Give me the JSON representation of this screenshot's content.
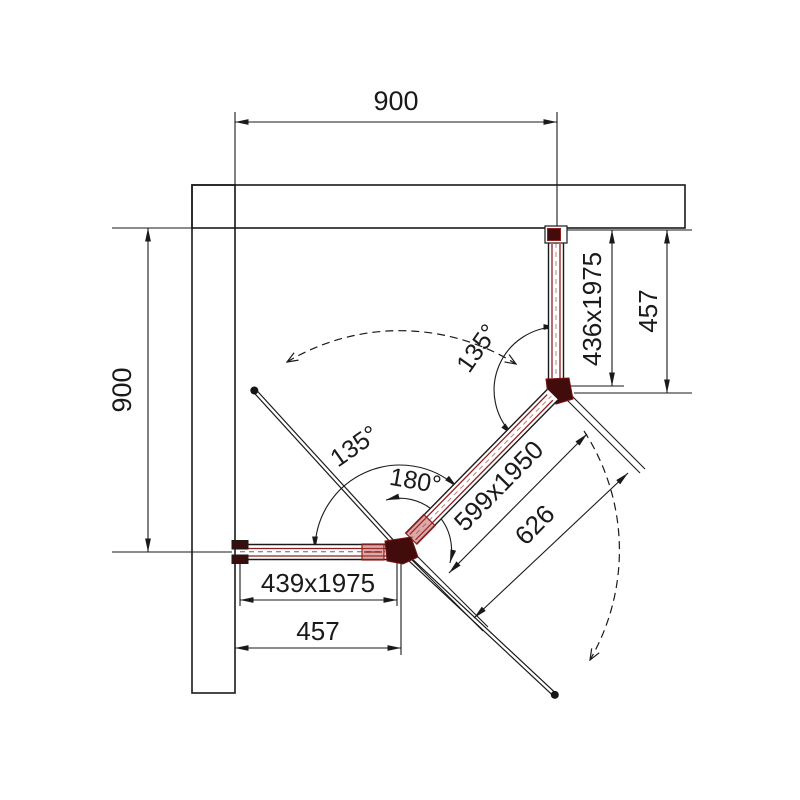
{
  "drawing": {
    "dimensions": {
      "top_width": "900",
      "left_height": "900",
      "right_panel_size": "436x1975",
      "right_wall_offset": "457",
      "door_panel_size": "599x1950",
      "door_clearance": "626",
      "bottom_panel_size": "439x1975",
      "bottom_wall_offset": "457"
    },
    "angles": {
      "right_corner": "135°",
      "left_corner": "135°",
      "door_swing": "180°"
    },
    "colors": {
      "line": "#1a1a1a",
      "profile_red": "#8f1d1d",
      "profile_red_light": "#c08080",
      "joint_dark": "#420c0c",
      "background": "#ffffff"
    }
  }
}
